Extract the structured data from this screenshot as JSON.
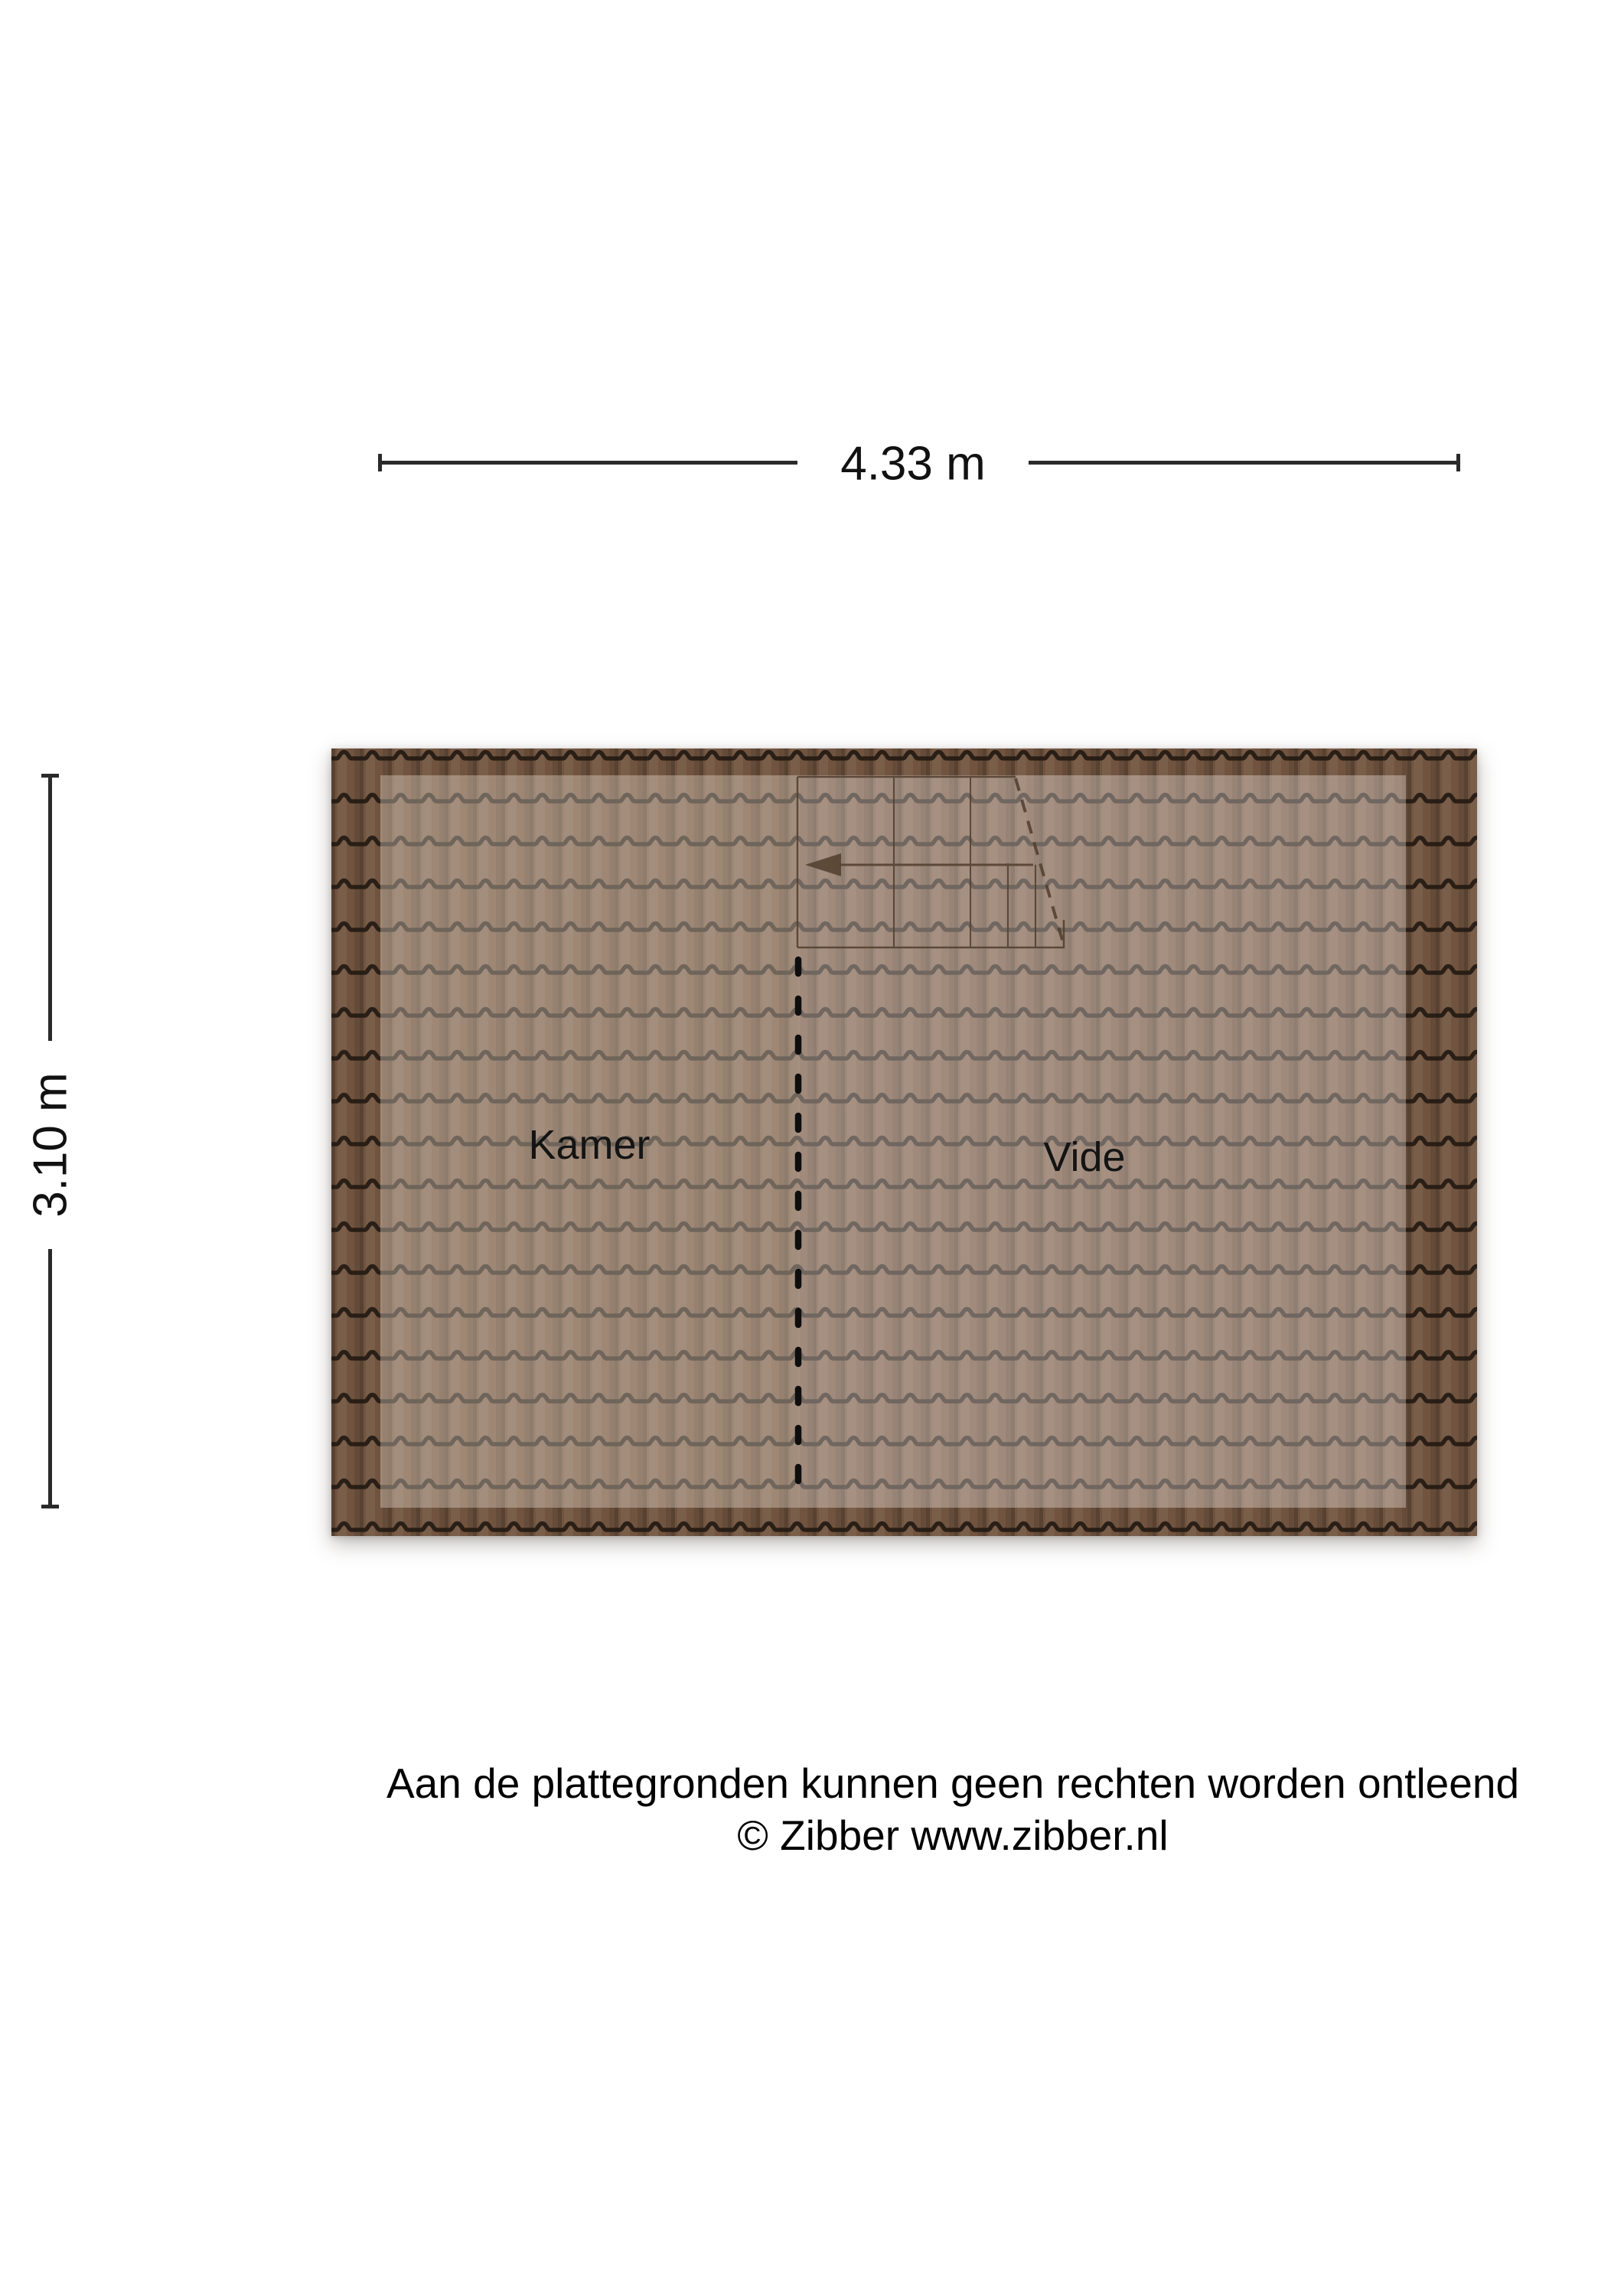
{
  "dimensions": {
    "horizontal": {
      "label": "4.33 m"
    },
    "vertical": {
      "label": "3.10 m"
    }
  },
  "rooms": {
    "kamer": "Kamer",
    "vide": "Vide"
  },
  "footer": {
    "disclaimer": "Aan de plattegronden kunnen geen rechten worden ontleend",
    "copyright": "© Zibber www.zibber.nl"
  },
  "colors": {
    "background": "#ffffff",
    "tile_body": "#71543f",
    "tile_line": "#241a12",
    "dimension_line": "#2a2a2a",
    "divider": "#0e0e0e",
    "stair_line": "#53402f"
  }
}
